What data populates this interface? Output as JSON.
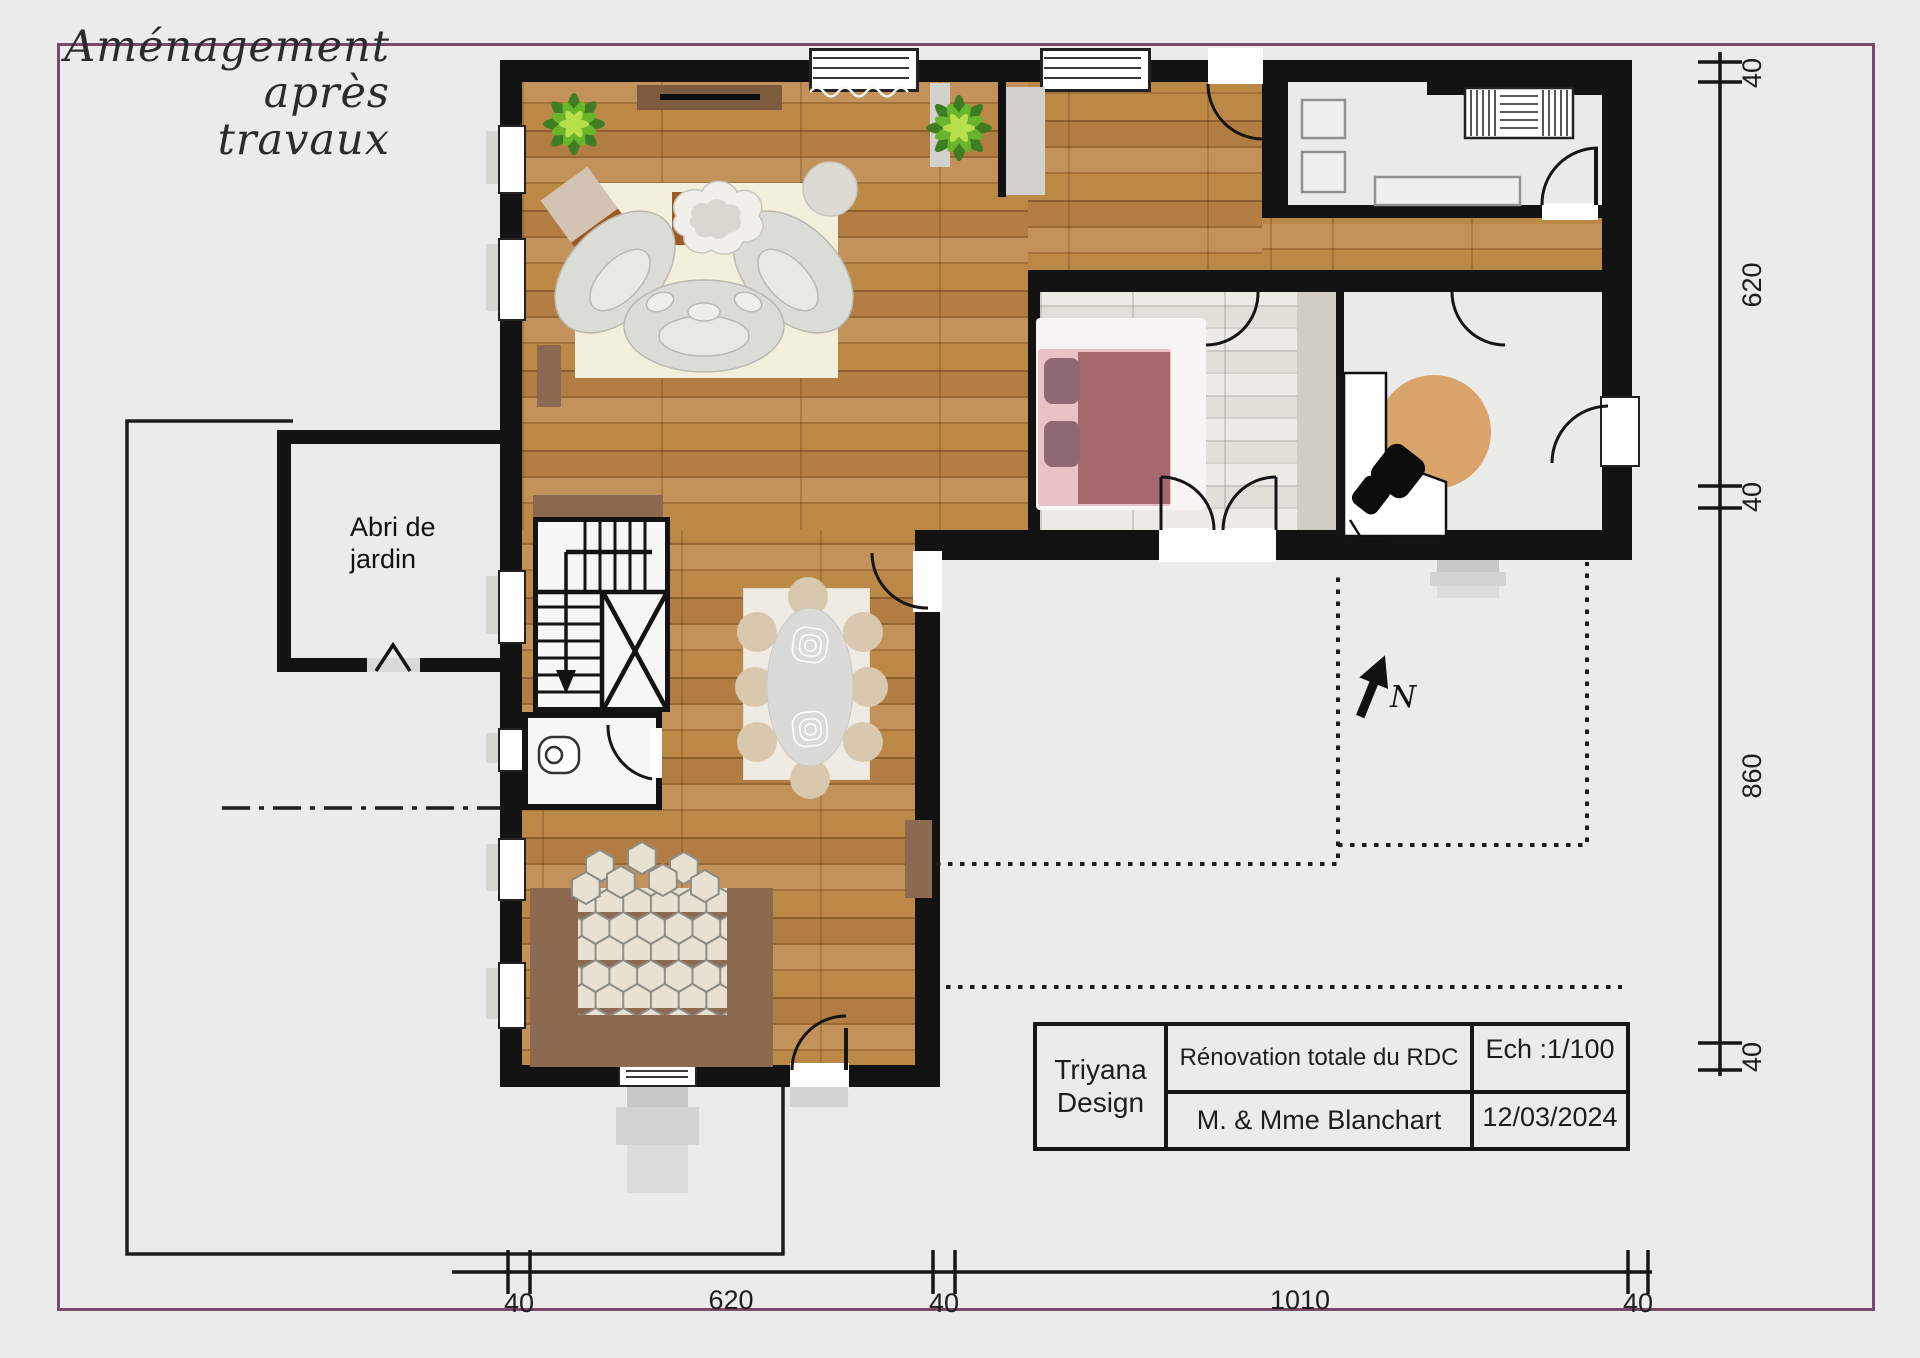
{
  "page": {
    "background": "#ebebeb",
    "frame_color": "#7b4a68",
    "title_line1": "Aménagement après",
    "title_line2": "travaux"
  },
  "plan": {
    "shed_line1": "Abri de",
    "shed_line2": "jardin",
    "north": "N"
  },
  "dimensions": {
    "right": [
      {
        "value": "40"
      },
      {
        "value": "620"
      },
      {
        "value": "40"
      },
      {
        "value": "860"
      },
      {
        "value": "40"
      }
    ],
    "bottom": [
      {
        "value": "40"
      },
      {
        "value": "620"
      },
      {
        "value": "40"
      },
      {
        "value": "1010"
      },
      {
        "value": "40"
      }
    ]
  },
  "title_block": {
    "company_line1": "Triyana",
    "company_line2": "Design",
    "project": "Rénovation totale du RDC",
    "scale": "Ech :1/100",
    "client": "M. & Mme Blanchart",
    "date": "12/03/2024"
  },
  "colors": {
    "wall": "#131313",
    "parquet": "#b5813f",
    "whitewash_floor": "#e6e4df",
    "room_floor": "#eaeae8",
    "counter_brown": "#8b6a51",
    "bed_mauve": "#a5686e",
    "office_rug_tan": "#d9a469",
    "plant_green": "#5f9e2f",
    "line_black": "#1c1c1c"
  }
}
